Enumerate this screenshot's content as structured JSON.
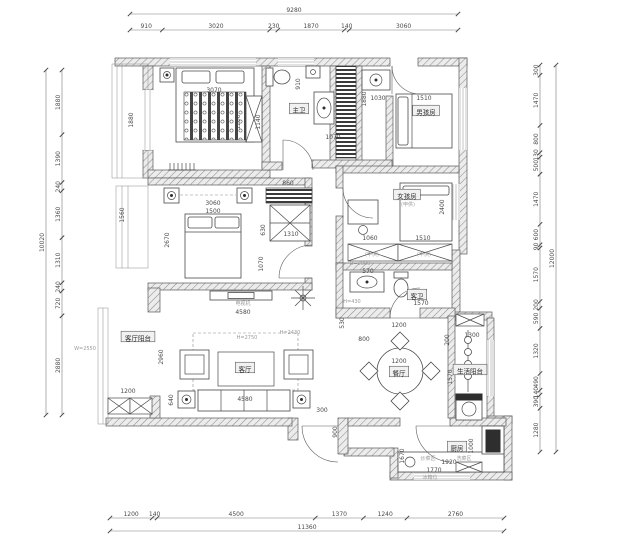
{
  "drawing": {
    "kind": "apartment-floor-plan",
    "language": "zh-CN",
    "background": "#ffffff",
    "line_color": "#5a5a5a",
    "dim_color": "#4a4a4a",
    "annotation_color": "#9a9a9a"
  },
  "chart_data": {
    "type": "table",
    "title": "户型平面布置图 dimension chains (mm)",
    "overall": {
      "top_total": 9280,
      "bottom_total": 11360,
      "left_total": 10020,
      "right_total": 12000
    }
  },
  "dim_chains": [
    {
      "key": "top",
      "orient": "h",
      "x0": 130,
      "x1": 458,
      "y": 30,
      "total": "9280",
      "total_pos": 14,
      "segments": [
        910,
        3020,
        230,
        1870,
        140,
        3060
      ]
    },
    {
      "key": "bottom",
      "orient": "h",
      "x0": 110,
      "x1": 504,
      "y": 518,
      "total": "11360",
      "total_pos": 531,
      "segments": [
        1200,
        140,
        4500,
        1370,
        1240,
        2760
      ]
    },
    {
      "key": "left",
      "orient": "v",
      "y0": 70,
      "y1": 415,
      "x": 62,
      "total": "10020",
      "total_pos": 46,
      "segments": [
        1880,
        1390,
        240,
        1360,
        1310,
        240,
        720,
        2880
      ]
    },
    {
      "key": "right",
      "orient": "v",
      "y0": 65,
      "y1": 452,
      "x": 540,
      "total": "12000",
      "total_pos": 556,
      "segments": [
        300,
        1470,
        800,
        130,
        500,
        1470,
        600,
        90,
        1570,
        200,
        590,
        1320,
        490,
        140,
        390,
        1280
      ]
    }
  ],
  "room_labels": [
    {
      "key": "master-bath",
      "text": "主卫",
      "x": 299,
      "y": 111
    },
    {
      "key": "boys-room",
      "text": "男孩房",
      "x": 426,
      "y": 113
    },
    {
      "key": "girls-room",
      "text": "女孩房",
      "x": 407,
      "y": 197
    },
    {
      "key": "living-balcony",
      "text": "客厅阳台",
      "x": 138,
      "y": 339
    },
    {
      "key": "living-room",
      "text": "客厅",
      "x": 245,
      "y": 370
    },
    {
      "key": "dining-room",
      "text": "餐厅",
      "x": 399,
      "y": 374
    },
    {
      "key": "guest-bath",
      "text": "客卫",
      "x": 417,
      "y": 297
    },
    {
      "key": "service-balcony",
      "text": "生活阳台",
      "x": 470,
      "y": 372
    },
    {
      "key": "kitchen",
      "text": "厨房",
      "x": 457,
      "y": 449
    }
  ],
  "inner_dims": [
    {
      "t": "3070",
      "x": 214,
      "y": 92
    },
    {
      "t": "1880",
      "x": 133,
      "y": 120,
      "r": 1
    },
    {
      "t": "1200",
      "x": 240,
      "y": 122,
      "r": 1
    },
    {
      "t": "1140",
      "x": 260,
      "y": 122,
      "r": 1
    },
    {
      "t": "910",
      "x": 300,
      "y": 84,
      "r": 1
    },
    {
      "t": "1030",
      "x": 378,
      "y": 100
    },
    {
      "t": "1880",
      "x": 366,
      "y": 99,
      "r": 1
    },
    {
      "t": "1070",
      "x": 333,
      "y": 139
    },
    {
      "t": "1510",
      "x": 424,
      "y": 100
    },
    {
      "t": "3060",
      "x": 213,
      "y": 205
    },
    {
      "t": "1500",
      "x": 213,
      "y": 213
    },
    {
      "t": "2670",
      "x": 169,
      "y": 240,
      "r": 1
    },
    {
      "t": "1560",
      "x": 124,
      "y": 215,
      "r": 1
    },
    {
      "t": "860",
      "x": 288,
      "y": 185
    },
    {
      "t": "1310",
      "x": 291,
      "y": 236
    },
    {
      "t": "630",
      "x": 265,
      "y": 230,
      "r": 1
    },
    {
      "t": "1070",
      "x": 263,
      "y": 264,
      "r": 1
    },
    {
      "t": "1060",
      "x": 370,
      "y": 240
    },
    {
      "t": "1510",
      "x": 423,
      "y": 240
    },
    {
      "t": "2400",
      "x": 444,
      "y": 207,
      "r": 1
    },
    {
      "t": "570",
      "x": 368,
      "y": 273
    },
    {
      "t": "1570",
      "x": 421,
      "y": 305
    },
    {
      "t": "4580",
      "x": 243,
      "y": 314
    },
    {
      "t": "2960",
      "x": 163,
      "y": 357,
      "r": 1
    },
    {
      "t": "640",
      "x": 173,
      "y": 400,
      "r": 1
    },
    {
      "t": "1200",
      "x": 128,
      "y": 393
    },
    {
      "t": "4580",
      "x": 245,
      "y": 401
    },
    {
      "t": "530",
      "x": 344,
      "y": 323,
      "r": 1
    },
    {
      "t": "1200",
      "x": 399,
      "y": 327
    },
    {
      "t": "800",
      "x": 364,
      "y": 341
    },
    {
      "t": "200",
      "x": 449,
      "y": 340,
      "r": 1
    },
    {
      "t": "1200",
      "x": 399,
      "y": 363
    },
    {
      "t": "300",
      "x": 322,
      "y": 412
    },
    {
      "t": "900",
      "x": 337,
      "y": 432,
      "r": 1
    },
    {
      "t": "1300",
      "x": 472,
      "y": 337
    },
    {
      "t": "1570",
      "x": 452,
      "y": 377,
      "r": 1
    },
    {
      "t": "1000",
      "x": 473,
      "y": 446,
      "r": 1
    },
    {
      "t": "1670",
      "x": 404,
      "y": 456,
      "r": 1
    },
    {
      "t": "1920",
      "x": 449,
      "y": 464
    },
    {
      "t": "1770",
      "x": 434,
      "y": 472
    }
  ],
  "annotations": [
    {
      "t": "H=2080",
      "x": 360,
      "y": 265
    },
    {
      "t": "H=2430",
      "x": 290,
      "y": 334
    },
    {
      "t": "H=2750",
      "x": 247,
      "y": 339
    },
    {
      "t": "W=2550",
      "x": 85,
      "y": 350
    },
    {
      "t": "H=430",
      "x": 352,
      "y": 303
    },
    {
      "t": "(甲供)",
      "x": 408,
      "y": 206
    },
    {
      "t": "(甲供)",
      "x": 372,
      "y": 256
    },
    {
      "t": "(甲供)",
      "x": 424,
      "y": 256
    },
    {
      "t": "电视机",
      "x": 243,
      "y": 305
    },
    {
      "t": "炒菜区",
      "x": 428,
      "y": 460
    },
    {
      "t": "洗菜区",
      "x": 464,
      "y": 460
    },
    {
      "t": "冰箱位",
      "x": 430,
      "y": 479
    }
  ]
}
